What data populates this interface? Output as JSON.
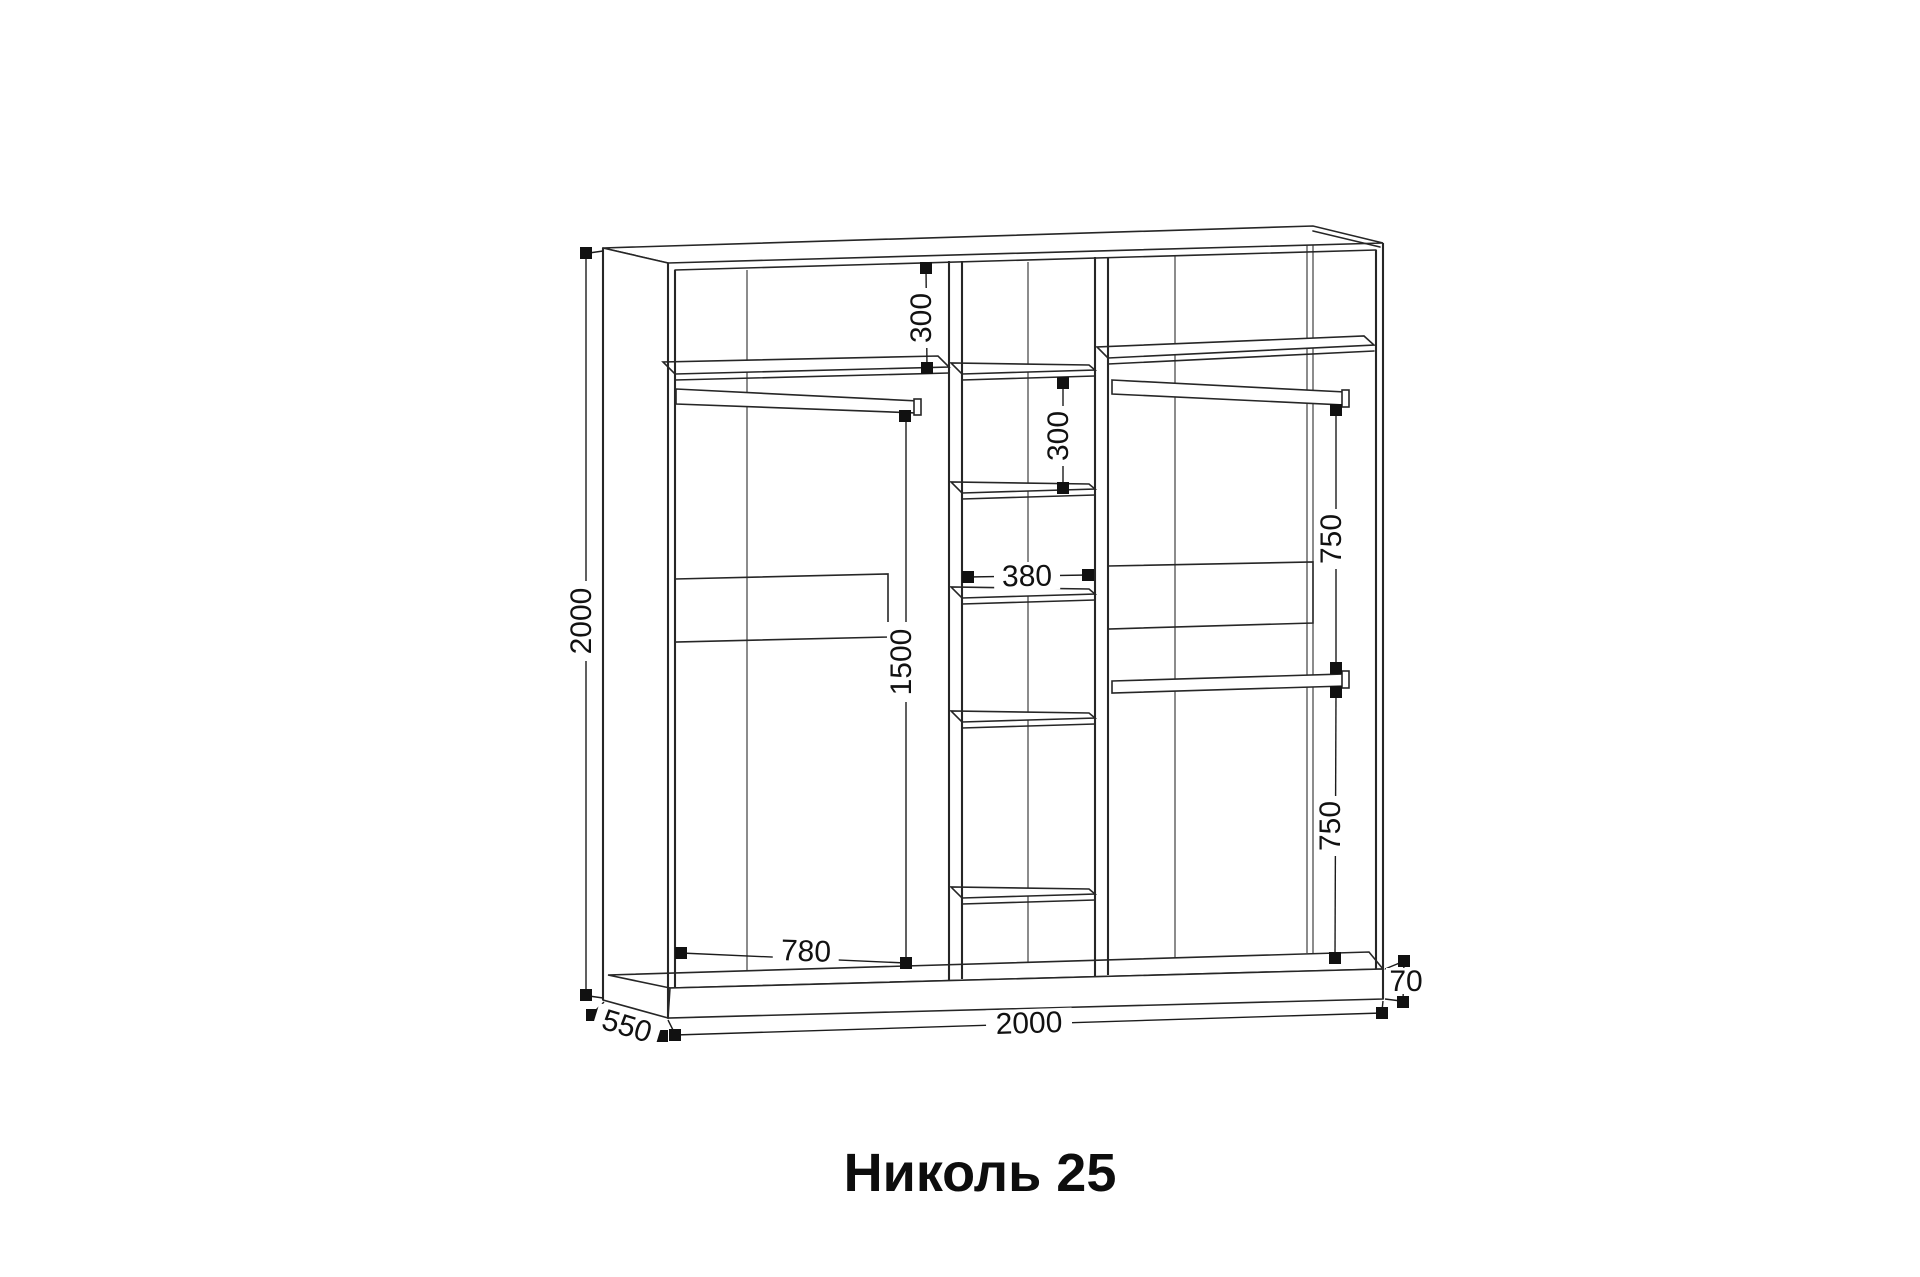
{
  "drawing": {
    "type": "furniture-technical-drawing",
    "item": "wardrobe"
  },
  "colors": {
    "background": "#ffffff",
    "line": "#262626",
    "label_text": "#111111"
  },
  "labels": {
    "title": "Николь 25",
    "dim_overall_height": "2000",
    "dim_overall_width": "2000",
    "dim_depth": "550",
    "dim_plinth_height": "70",
    "dim_top_shelf_drop": "300",
    "dim_middle_shelf_gap": "300",
    "dim_middle_column_width": "380",
    "dim_left_hanging_height": "1500",
    "dim_left_section_width": "780",
    "dim_right_upper_hanging": "750",
    "dim_right_lower_hanging": "750"
  }
}
